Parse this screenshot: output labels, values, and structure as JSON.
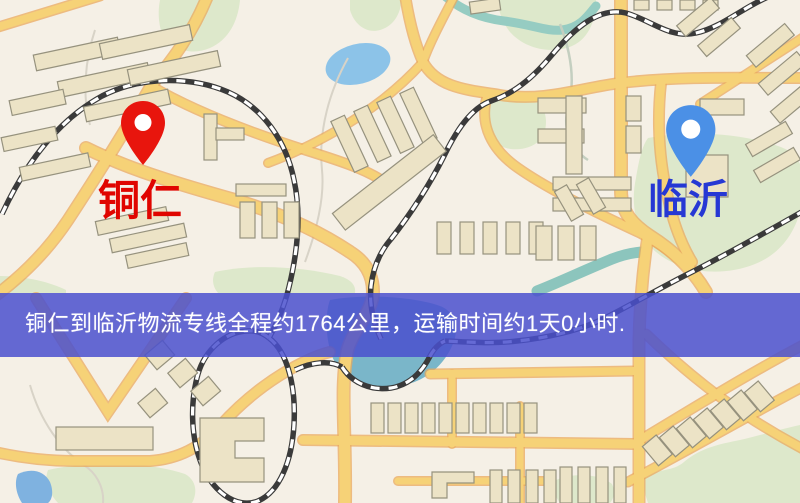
{
  "map": {
    "origin": {
      "name": "铜仁"
    },
    "destination": {
      "name": "临沂"
    },
    "banner": {
      "text": "铜仁到临沂物流专线全程约1764公里，运输时间约1天0小时."
    },
    "route": {
      "distance_text": "约1764公里",
      "duration_text": "约1天0小时"
    }
  },
  "colors": {
    "map_bg": "#f5f0e6",
    "origin_pin": "#e8150d",
    "origin_label": "#e00500",
    "destination_pin": "#4b90e6",
    "destination_label": "#2638d4",
    "banner_bg": "rgba(74,80,206,0.85)",
    "banner_text": "#ffffff",
    "road_fill": "#f6d277",
    "road_casing": "#eaa95e",
    "building": "#ece3c6",
    "water": "#8cc3e8",
    "park": "#dde8cb"
  }
}
